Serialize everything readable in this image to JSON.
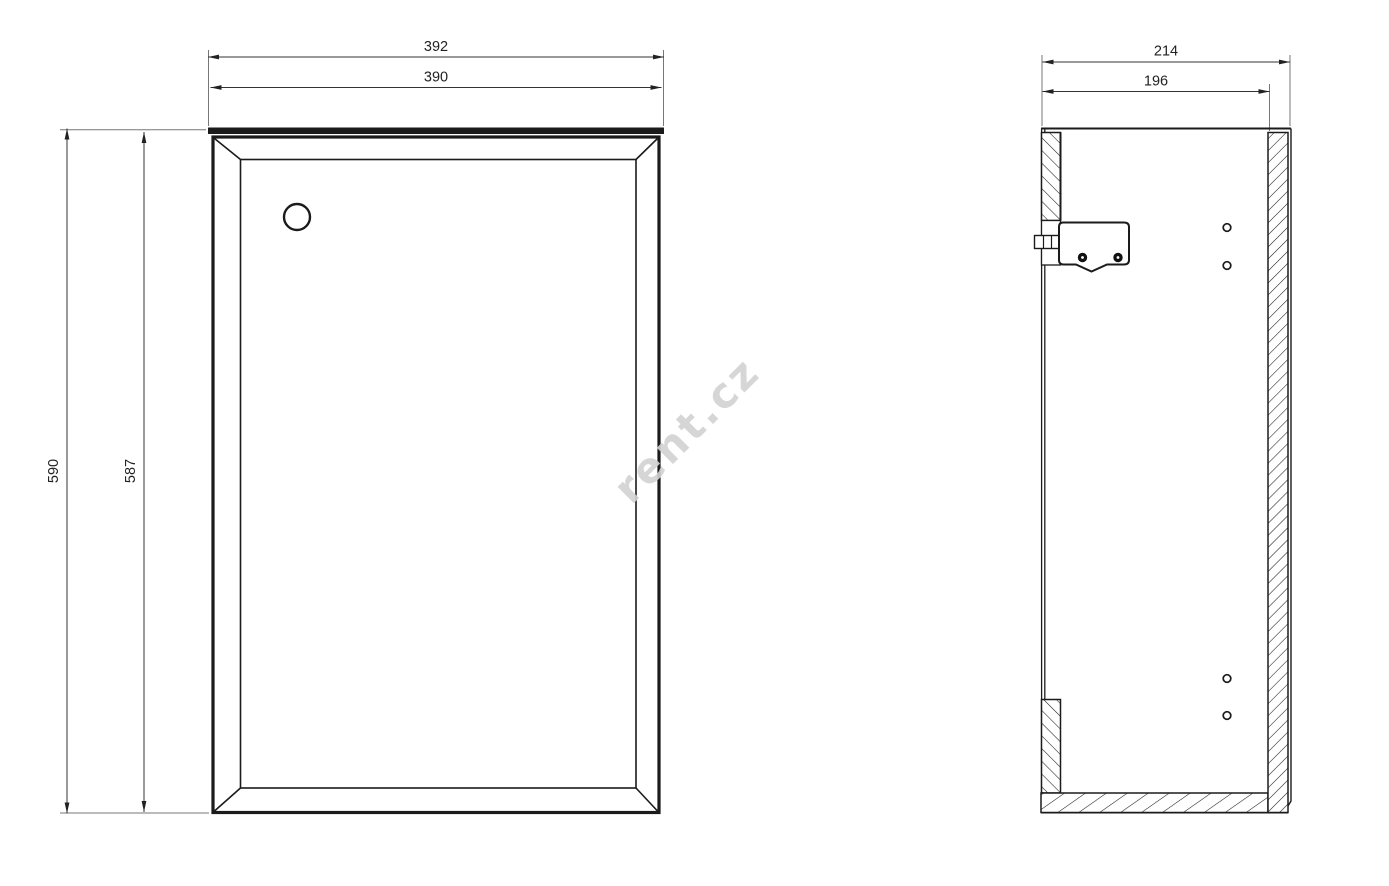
{
  "watermark": {
    "text": "rent.cz",
    "color": "#d2d2d2"
  },
  "front_view": {
    "dim_width_overall": "392",
    "dim_width_door": "390",
    "dim_height_overall": "590",
    "dim_height_door": "587"
  },
  "side_view": {
    "dim_depth_overall": "214",
    "dim_depth_inner": "196"
  },
  "colors": {
    "line": "#1b1b1b",
    "dim_text": "#222222",
    "background": "#ffffff"
  }
}
